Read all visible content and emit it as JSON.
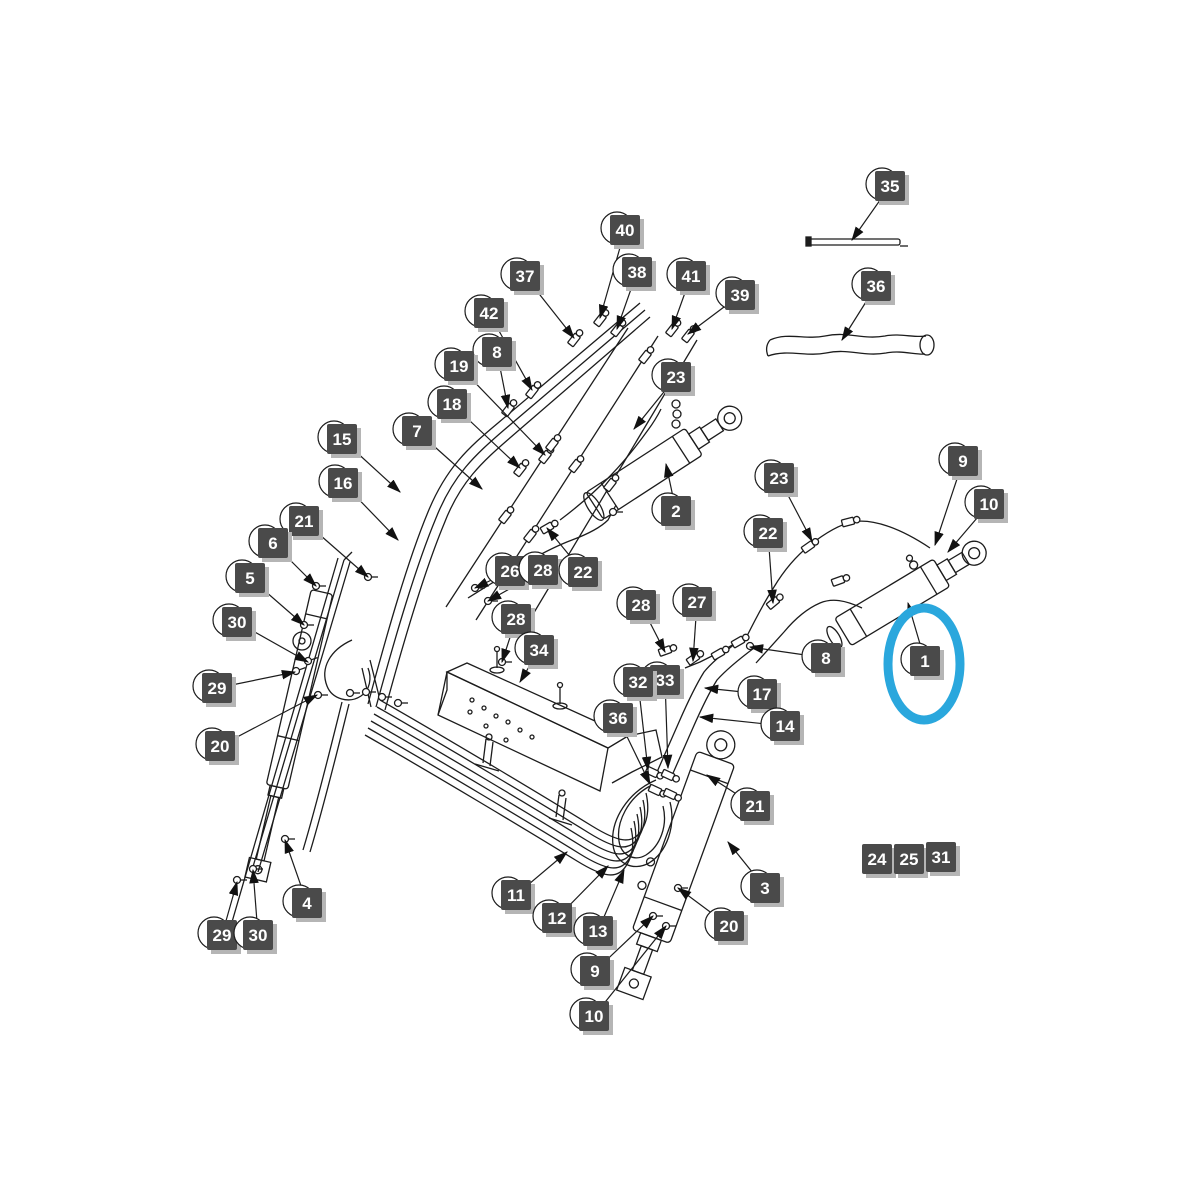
{
  "diagram": {
    "background_color": "#ffffff",
    "line_color": "#1c1c1c",
    "callout_style": {
      "square_color": "#4a4a4a",
      "text_color": "#ffffff",
      "shadow_color": "#b5b5b5",
      "balloon_stroke": "#1c1c1c"
    },
    "highlight_ellipse": {
      "color": "#2aa7dd",
      "cx": 924,
      "cy": 664,
      "rx": 36,
      "ry": 56,
      "stroke_width": 9,
      "encircles_label": "1"
    },
    "callouts": [
      {
        "label": "35",
        "x": 890,
        "y": 186,
        "tx": 852,
        "ty": 240
      },
      {
        "label": "40",
        "x": 625,
        "y": 230,
        "tx": 600,
        "ty": 318
      },
      {
        "label": "38",
        "x": 637,
        "y": 272,
        "tx": 617,
        "ty": 329
      },
      {
        "label": "37",
        "x": 525,
        "y": 276,
        "tx": 574,
        "ty": 338
      },
      {
        "label": "41",
        "x": 691,
        "y": 276,
        "tx": 672,
        "ty": 329
      },
      {
        "label": "36",
        "x": 876,
        "y": 286,
        "tx": 842,
        "ty": 340
      },
      {
        "label": "39",
        "x": 740,
        "y": 295,
        "tx": 688,
        "ty": 334
      },
      {
        "label": "42",
        "x": 489,
        "y": 313,
        "tx": 532,
        "ty": 390
      },
      {
        "label": "8",
        "x": 497,
        "y": 352,
        "tx": 508,
        "ty": 408
      },
      {
        "label": "19",
        "x": 459,
        "y": 366,
        "tx": 545,
        "ty": 455
      },
      {
        "label": "23",
        "x": 676,
        "y": 377,
        "tx": 634,
        "ty": 429
      },
      {
        "label": "18",
        "x": 452,
        "y": 404,
        "tx": 520,
        "ty": 468
      },
      {
        "label": "7",
        "x": 417,
        "y": 431,
        "tx": 482,
        "ty": 489
      },
      {
        "label": "15",
        "x": 342,
        "y": 439,
        "tx": 400,
        "ty": 492
      },
      {
        "label": "9",
        "x": 963,
        "y": 461,
        "tx": 935,
        "ty": 545
      },
      {
        "label": "23",
        "x": 779,
        "y": 478,
        "tx": 812,
        "ty": 541
      },
      {
        "label": "16",
        "x": 343,
        "y": 483,
        "tx": 398,
        "ty": 540
      },
      {
        "label": "10",
        "x": 989,
        "y": 504,
        "tx": 948,
        "ty": 552
      },
      {
        "label": "2",
        "x": 676,
        "y": 511,
        "tx": 666,
        "ty": 464
      },
      {
        "label": "21",
        "x": 304,
        "y": 521,
        "tx": 368,
        "ty": 577
      },
      {
        "label": "22",
        "x": 768,
        "y": 533,
        "tx": 773,
        "ty": 603
      },
      {
        "label": "6",
        "x": 273,
        "y": 543,
        "tx": 316,
        "ty": 586
      },
      {
        "label": "26",
        "x": 510,
        "y": 571,
        "tx": 475,
        "ty": 588
      },
      {
        "label": "28",
        "x": 543,
        "y": 570,
        "tx": 488,
        "ty": 601
      },
      {
        "label": "22",
        "x": 583,
        "y": 572,
        "tx": 547,
        "ty": 528
      },
      {
        "label": "5",
        "x": 250,
        "y": 578,
        "tx": 304,
        "ty": 625
      },
      {
        "label": "28",
        "x": 641,
        "y": 605,
        "tx": 665,
        "ty": 652
      },
      {
        "label": "27",
        "x": 697,
        "y": 602,
        "tx": 693,
        "ty": 661
      },
      {
        "label": "30",
        "x": 237,
        "y": 622,
        "tx": 308,
        "ty": 662
      },
      {
        "label": "28",
        "x": 516,
        "y": 619,
        "tx": 502,
        "ty": 662
      },
      {
        "label": "34",
        "x": 539,
        "y": 650,
        "tx": 520,
        "ty": 682
      },
      {
        "label": "8",
        "x": 826,
        "y": 658,
        "tx": 750,
        "ty": 647
      },
      {
        "label": "1",
        "x": 925,
        "y": 661,
        "tx": 908,
        "ty": 603
      },
      {
        "label": "33",
        "x": 665,
        "y": 680,
        "tx": 668,
        "ty": 768
      },
      {
        "label": "32",
        "x": 638,
        "y": 682,
        "tx": 648,
        "ty": 770
      },
      {
        "label": "29",
        "x": 217,
        "y": 688,
        "tx": 295,
        "ty": 672
      },
      {
        "label": "17",
        "x": 762,
        "y": 694,
        "tx": 705,
        "ty": 688
      },
      {
        "label": "36",
        "x": 618,
        "y": 718,
        "tx": 650,
        "ty": 784
      },
      {
        "label": "14",
        "x": 785,
        "y": 726,
        "tx": 700,
        "ty": 717
      },
      {
        "label": "20",
        "x": 220,
        "y": 746,
        "tx": 317,
        "ty": 695
      },
      {
        "label": "21",
        "x": 755,
        "y": 806,
        "tx": 707,
        "ty": 775
      },
      {
        "label": "24",
        "x": 877,
        "y": 859,
        "plain": true
      },
      {
        "label": "25",
        "x": 909,
        "y": 859,
        "plain": true
      },
      {
        "label": "31",
        "x": 941,
        "y": 857,
        "plain": true
      },
      {
        "label": "3",
        "x": 765,
        "y": 888,
        "tx": 728,
        "ty": 842
      },
      {
        "label": "11",
        "x": 516,
        "y": 895,
        "tx": 567,
        "ty": 852
      },
      {
        "label": "4",
        "x": 307,
        "y": 903,
        "tx": 285,
        "ty": 840
      },
      {
        "label": "12",
        "x": 557,
        "y": 918,
        "tx": 608,
        "ty": 866
      },
      {
        "label": "13",
        "x": 598,
        "y": 931,
        "tx": 624,
        "ty": 870
      },
      {
        "label": "20",
        "x": 729,
        "y": 926,
        "tx": 678,
        "ty": 888
      },
      {
        "label": "29",
        "x": 222,
        "y": 935,
        "tx": 237,
        "ty": 882
      },
      {
        "label": "30",
        "x": 258,
        "y": 935,
        "tx": 253,
        "ty": 870
      },
      {
        "label": "9",
        "x": 595,
        "y": 971,
        "tx": 653,
        "ty": 916
      },
      {
        "label": "10",
        "x": 594,
        "y": 1016,
        "tx": 666,
        "ty": 926
      }
    ]
  }
}
